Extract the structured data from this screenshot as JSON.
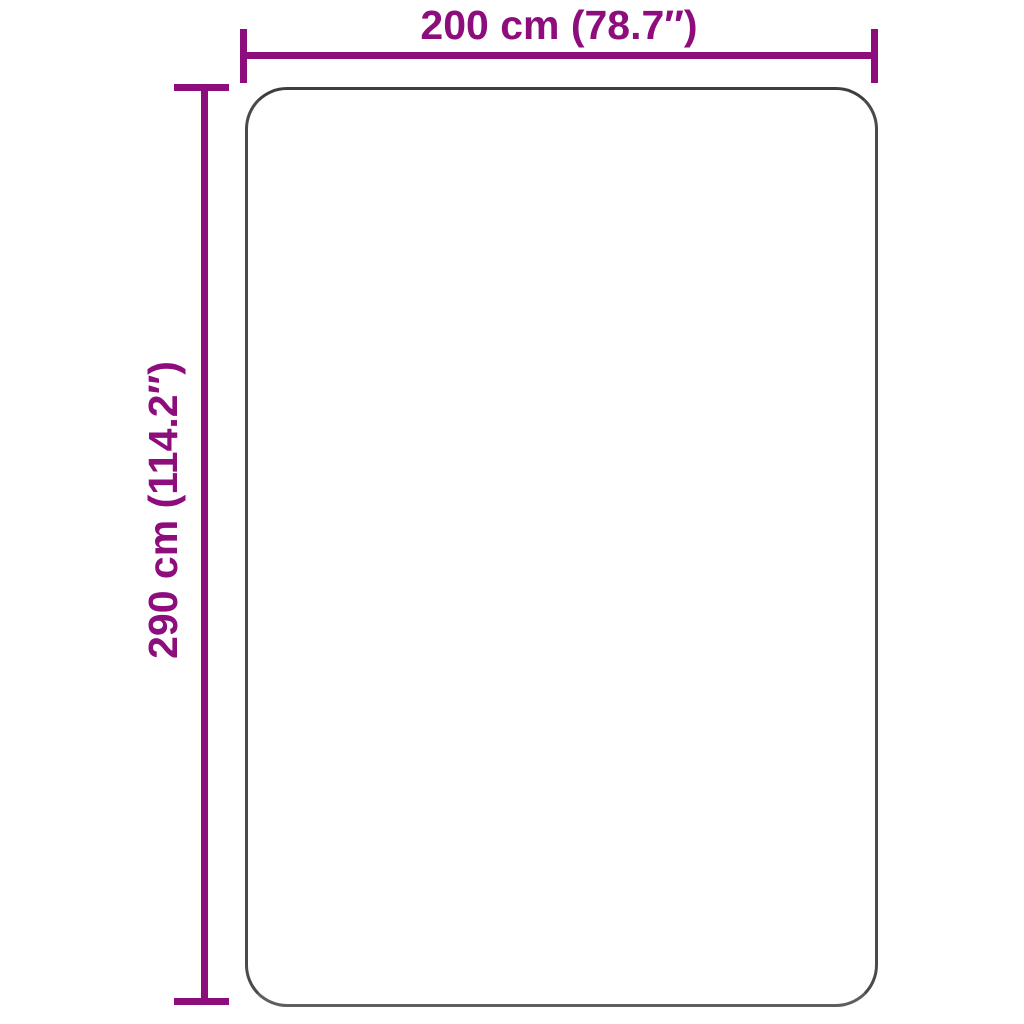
{
  "diagram": {
    "type": "product-dimension-diagram",
    "width_label": "200 cm (78.7″)",
    "height_label": "290 cm (114.2″)",
    "width_cm": 200,
    "width_inches": 78.7,
    "height_cm": 290,
    "height_inches": 114.2
  },
  "colors": {
    "dimension": "#8D0D7D",
    "outline": "#4A4A4A",
    "background": "#FFFFFF"
  }
}
